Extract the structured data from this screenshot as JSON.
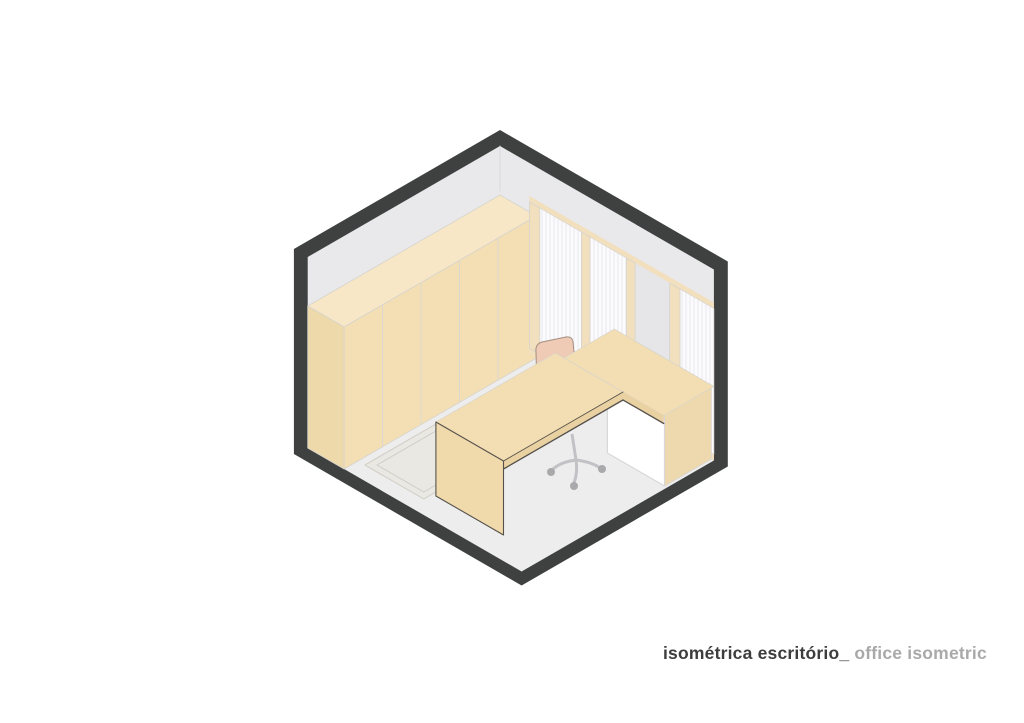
{
  "page": {
    "background_color": "#ffffff"
  },
  "figure": {
    "type": "isometric-architectural-drawing",
    "subject": "office room cutaway axonometric",
    "parts": [
      "outer-wall-shell",
      "left-wall",
      "right-window-wall",
      "floor",
      "rug",
      "full-height-wardrobe",
      "windows-with-vertical-blinds",
      "window-mullions",
      "l-shaped-desk",
      "desk-side-panel",
      "under-desk-cabinet",
      "office-chair"
    ],
    "palette": {
      "shell_dark": "#3f4040",
      "wall_gray": "#e9e9eb",
      "floor_gray": "#ededed",
      "rug_fill": "#eae8e2",
      "rug_border": "#cfccc5",
      "wardrobe_front": "#f4dfb4",
      "wardrobe_top": "#f7e7c6",
      "wardrobe_end": "#eed9ab",
      "seam_line": "#dbd8d0",
      "window_white": "#fbfbfd",
      "blind_stripe": "#e7e7ee",
      "mullion_beige": "#f2dfbd",
      "wall_panel_gray": "#e6e6e8",
      "desk_top": "#f3deb3",
      "desk_edge": "#ead1a2",
      "desk_leg": "#f0d9ab",
      "desk_leg_side": "#e5caa0",
      "desk_outline": "#56524b",
      "cabinet_white": "#ffffff",
      "cabinet_line": "#d8d8da",
      "side_panel_beige": "#eed9ae",
      "chair_back": "#efcab5",
      "chair_outline": "#a58f80",
      "chair_base_gray": "#c2c2c6",
      "caster_gray": "#a9a9ac",
      "face_edge_light": "#d6d4cd",
      "gray_edge_light": "#d9d9db"
    }
  },
  "caption": {
    "primary": "isométrica escritório_",
    "secondary": " office isometric",
    "primary_color": "#3d3d3d",
    "secondary_color": "#a9a9a9"
  }
}
